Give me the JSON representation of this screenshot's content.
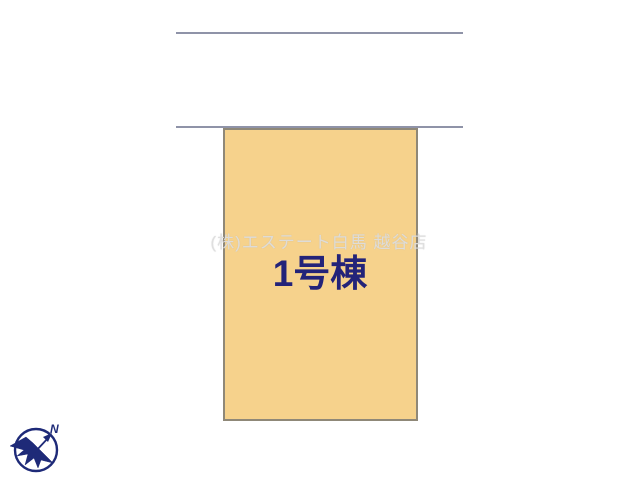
{
  "page": {
    "background_color": "#ffffff",
    "type": "real-estate-site-plan"
  },
  "road": {
    "line_color": "#8f93a8",
    "line_count": 2
  },
  "lot": {
    "label": "1号棟",
    "label_color": "#232379",
    "fill_color": "#f6d28c",
    "border_color": "#8f8878"
  },
  "watermark": {
    "text": "(株)エステート白馬 越谷店",
    "color": "#dedede"
  },
  "compass": {
    "label": "N",
    "color": "#1e2a78",
    "icon": "north-compass-bird"
  }
}
